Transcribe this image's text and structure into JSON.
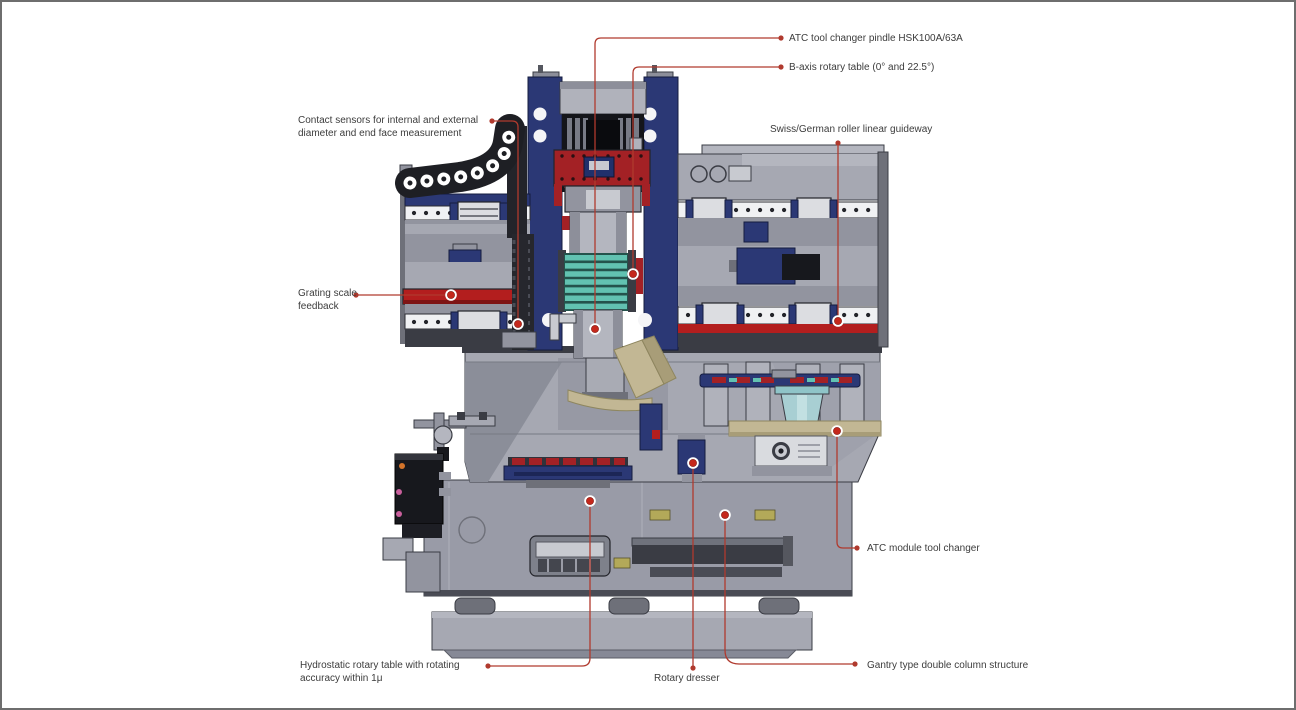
{
  "page": {
    "background": "#ffffff",
    "border_color": "#6e6e6e"
  },
  "colors": {
    "page-border": "#6e6e6e",
    "label-text": "#3c3c3c",
    "callout-line": "#b03a2e",
    "callout-dot": "#c5281c",
    "navy": "#2b3875",
    "navy-dark": "#141c3f",
    "red-panel": "#a32125",
    "red-bright": "#b31e1e",
    "teal": "#62c2b1",
    "teal-cyl": "#a8cfd3",
    "tan": "#c2b794",
    "olive": "#b3a959",
    "gray-1": "#a6a8b2",
    "gray-2": "#92949f",
    "gray-3": "#6e7079",
    "gray-4": "#3a3c44",
    "black-part": "#17181d",
    "white-rail": "#f0f1f3",
    "metal": "#c8cad0"
  },
  "callouts": [
    {
      "id": "atc-spindle",
      "label": "ATC tool changer pindle HSK100A/63A"
    },
    {
      "id": "b-axis",
      "label": "B-axis rotary table (0° and 22.5°)"
    },
    {
      "id": "contact-sensors",
      "label": "Contact sensors for internal and external\ndiameter and end face measurement"
    },
    {
      "id": "grating-scale",
      "label": "Grating scale\nfeedback"
    },
    {
      "id": "linear-guideway",
      "label": "Swiss/German roller linear guideway"
    },
    {
      "id": "atc-module",
      "label": "ATC module tool changer"
    },
    {
      "id": "hydrostatic-table",
      "label": "Hydrostatic rotary table with rotating\naccuracy within 1μ"
    },
    {
      "id": "rotary-dresser",
      "label": "Rotary dresser"
    },
    {
      "id": "gantry-structure",
      "label": "Gantry type double column structure"
    }
  ]
}
